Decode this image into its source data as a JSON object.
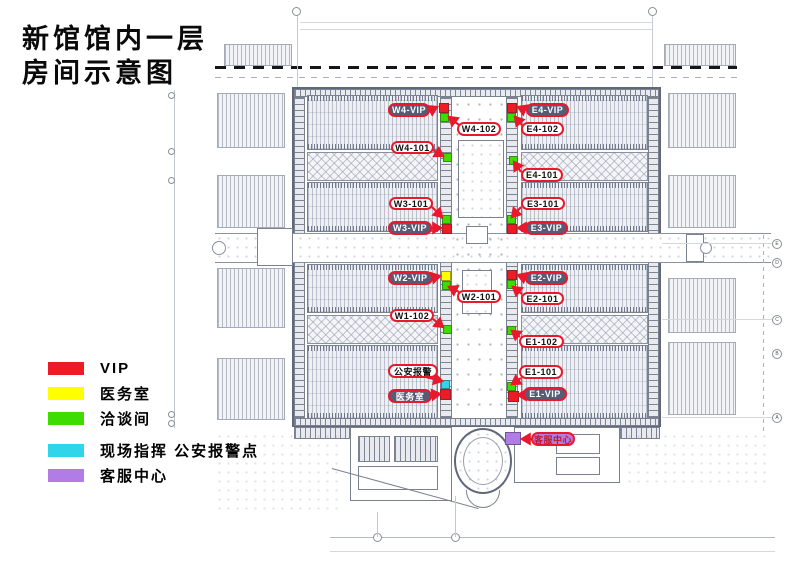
{
  "title": {
    "line1": "新馆馆内一层",
    "line2": "房间示意图"
  },
  "legend": {
    "items": [
      {
        "label": "VIP",
        "color": "#ed1c24"
      },
      {
        "label": "医务室",
        "color": "#ffff00"
      },
      {
        "label": "洽谈间",
        "color": "#3fdc00"
      },
      {
        "label": "现场指挥 公安报警点",
        "color": "#2fd5e8"
      },
      {
        "label": "客服中心",
        "color": "#b27ce6"
      }
    ]
  },
  "plan": {
    "palette": {
      "red": "#ed1c24",
      "green": "#3fdc00",
      "yellow": "#ffff00",
      "cyan": "#2fd5e8",
      "purple": "#b27ce6"
    },
    "callout_border_color": "#e8192c",
    "callouts": [
      {
        "id": "w4-vip",
        "label": "W4-VIP",
        "style": "dark",
        "box": [
          388,
          103,
          42,
          14
        ],
        "arrow": [
          431,
          110,
          437,
          107
        ]
      },
      {
        "id": "e4-vip",
        "label": "E4-VIP",
        "style": "dark",
        "box": [
          526,
          103,
          43,
          14
        ],
        "arrow": [
          525,
          110,
          518,
          107
        ]
      },
      {
        "id": "w4-102",
        "label": "W4-102",
        "style": "white",
        "box": [
          457,
          122,
          44,
          14
        ],
        "arrow": [
          459,
          125,
          449,
          117
        ]
      },
      {
        "id": "e4-102",
        "label": "E4-102",
        "style": "white",
        "box": [
          521,
          122,
          43,
          14
        ],
        "arrow": [
          522,
          125,
          515,
          117
        ]
      },
      {
        "id": "w4-101",
        "label": "W4-101",
        "style": "white",
        "box": [
          391,
          141,
          43,
          13
        ],
        "arrow": [
          433,
          150,
          443,
          156
        ]
      },
      {
        "id": "e4-101",
        "label": "E4-101",
        "style": "white",
        "box": [
          521,
          168,
          42,
          14
        ],
        "arrow": [
          521,
          172,
          514,
          162
        ]
      },
      {
        "id": "w3-101",
        "label": "W3-101",
        "style": "white",
        "box": [
          389,
          197,
          44,
          13
        ],
        "arrow": [
          432,
          207,
          442,
          217
        ]
      },
      {
        "id": "e3-101",
        "label": "E3-101",
        "style": "white",
        "box": [
          521,
          197,
          44,
          13
        ],
        "arrow": [
          521,
          207,
          512,
          217
        ]
      },
      {
        "id": "w3-vip",
        "label": "W3-VIP",
        "style": "dark",
        "box": [
          388,
          221,
          44,
          14
        ],
        "arrow": [
          431,
          228,
          441,
          228
        ]
      },
      {
        "id": "e3-vip",
        "label": "E3-VIP",
        "style": "dark",
        "box": [
          525,
          221,
          43,
          14
        ],
        "arrow": [
          526,
          228,
          518,
          228
        ]
      },
      {
        "id": "w2-vip",
        "label": "W2-VIP",
        "style": "dark",
        "box": [
          388,
          271,
          45,
          14
        ],
        "arrow": [
          432,
          278,
          440,
          276
        ]
      },
      {
        "id": "e2-vip",
        "label": "E2-VIP",
        "style": "dark",
        "box": [
          525,
          271,
          43,
          14
        ],
        "arrow": [
          526,
          278,
          518,
          275
        ]
      },
      {
        "id": "w2-101",
        "label": "W2-101",
        "style": "white",
        "box": [
          457,
          290,
          44,
          13
        ],
        "arrow": [
          459,
          292,
          449,
          287
        ]
      },
      {
        "id": "e2-101",
        "label": "E2-101",
        "style": "white",
        "box": [
          521,
          292,
          43,
          13
        ],
        "arrow": [
          522,
          294,
          513,
          287
        ]
      },
      {
        "id": "w1-102",
        "label": "W1-102",
        "style": "white",
        "box": [
          390,
          309,
          44,
          13
        ],
        "arrow": [
          433,
          319,
          443,
          327
        ]
      },
      {
        "id": "e1-102",
        "label": "E1-102",
        "style": "white",
        "box": [
          519,
          335,
          45,
          13
        ],
        "arrow": [
          520,
          337,
          512,
          331
        ]
      },
      {
        "id": "gongan",
        "label": "公安报警",
        "style": "white",
        "box": [
          388,
          364,
          50,
          14
        ],
        "arrow": [
          426,
          377,
          442,
          381
        ]
      },
      {
        "id": "yiwushi",
        "label": "医务室",
        "style": "dark",
        "box": [
          388,
          389,
          44,
          14
        ],
        "arrow": [
          431,
          395,
          440,
          394
        ]
      },
      {
        "id": "e1-101",
        "label": "E1-101",
        "style": "white",
        "box": [
          519,
          365,
          44,
          14
        ],
        "arrow": [
          521,
          378,
          512,
          384
        ]
      },
      {
        "id": "e1-vip",
        "label": "E1-VIP",
        "style": "dark",
        "box": [
          523,
          387,
          44,
          14
        ],
        "arrow": [
          524,
          395,
          518,
          395
        ]
      },
      {
        "id": "kefu",
        "label": "客服中心",
        "style": "purple",
        "box": [
          531,
          432,
          44,
          14
        ],
        "arrow": [
          532,
          439,
          522,
          439
        ]
      }
    ],
    "markers": [
      {
        "id": "w4-vip",
        "color": "red",
        "x": 439,
        "y": 103,
        "w": 10,
        "h": 10
      },
      {
        "id": "w4-talk",
        "color": "green",
        "x": 440,
        "y": 113,
        "w": 9,
        "h": 9
      },
      {
        "id": "e4-vip",
        "color": "red",
        "x": 507,
        "y": 103,
        "w": 10,
        "h": 10
      },
      {
        "id": "e4-talk",
        "color": "green",
        "x": 507,
        "y": 113,
        "w": 9,
        "h": 9
      },
      {
        "id": "w4-101",
        "color": "green",
        "x": 443,
        "y": 153,
        "w": 9,
        "h": 9
      },
      {
        "id": "e4-101",
        "color": "green",
        "x": 509,
        "y": 156,
        "w": 9,
        "h": 9
      },
      {
        "id": "w3-101",
        "color": "green",
        "x": 442,
        "y": 215,
        "w": 9,
        "h": 9
      },
      {
        "id": "w3-vip",
        "color": "red",
        "x": 442,
        "y": 224,
        "w": 10,
        "h": 10
      },
      {
        "id": "e3-101",
        "color": "green",
        "x": 507,
        "y": 215,
        "w": 9,
        "h": 9
      },
      {
        "id": "e3-vip",
        "color": "red",
        "x": 507,
        "y": 224,
        "w": 10,
        "h": 10
      },
      {
        "id": "w2-med",
        "color": "yellow",
        "x": 441,
        "y": 271,
        "w": 10,
        "h": 10
      },
      {
        "id": "w2-talk",
        "color": "green",
        "x": 442,
        "y": 281,
        "w": 9,
        "h": 9
      },
      {
        "id": "e2-vip",
        "color": "red",
        "x": 507,
        "y": 270,
        "w": 10,
        "h": 10
      },
      {
        "id": "e2-talk",
        "color": "green",
        "x": 507,
        "y": 280,
        "w": 9,
        "h": 9
      },
      {
        "id": "w1-102",
        "color": "green",
        "x": 443,
        "y": 325,
        "w": 9,
        "h": 9
      },
      {
        "id": "e1-102",
        "color": "green",
        "x": 507,
        "y": 326,
        "w": 9,
        "h": 9
      },
      {
        "id": "alarm",
        "color": "cyan",
        "x": 441,
        "y": 380,
        "w": 9,
        "h": 9
      },
      {
        "id": "med",
        "color": "red",
        "x": 440,
        "y": 389,
        "w": 11,
        "h": 11
      },
      {
        "id": "e1-101",
        "color": "green",
        "x": 507,
        "y": 382,
        "w": 9,
        "h": 9
      },
      {
        "id": "e1-vip",
        "color": "red",
        "x": 508,
        "y": 391,
        "w": 11,
        "h": 11
      },
      {
        "id": "service",
        "color": "purple",
        "x": 505,
        "y": 432,
        "w": 16,
        "h": 13
      }
    ],
    "grid_bubbles": [
      {
        "label": "E",
        "y": 239
      },
      {
        "label": "D",
        "y": 258
      },
      {
        "label": "C",
        "y": 315
      },
      {
        "label": "B",
        "y": 349
      },
      {
        "label": "A",
        "y": 413
      }
    ]
  }
}
